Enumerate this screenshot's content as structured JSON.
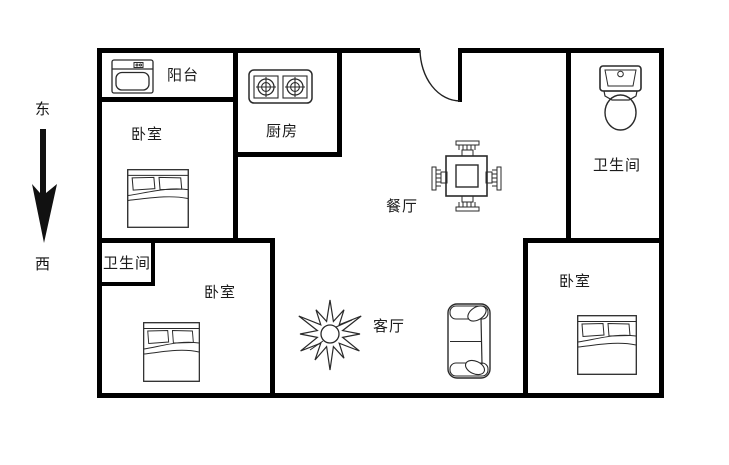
{
  "page": {
    "type": "apartment-floor-plan",
    "background_color": "#ffffff",
    "wall_color": "#000000",
    "furniture_line_color": "#2a2a2a"
  },
  "compass": {
    "east_label": "东",
    "west_label": "西",
    "arrow_direction": "down"
  },
  "rooms": [
    {
      "name": "balcony",
      "label": "阳台"
    },
    {
      "name": "bedroom-northwest",
      "label": "卧室"
    },
    {
      "name": "kitchen",
      "label": "厨房"
    },
    {
      "name": "dining-room",
      "label": "餐厅"
    },
    {
      "name": "bathroom-north",
      "label": "卫生间"
    },
    {
      "name": "bathroom-west",
      "label": "卫生间"
    },
    {
      "name": "bedroom-southwest",
      "label": "卧室"
    },
    {
      "name": "living-room",
      "label": "客厅"
    },
    {
      "name": "bedroom-southeast",
      "label": "卧室"
    }
  ],
  "furniture": [
    {
      "name": "washbasin",
      "room": "balcony"
    },
    {
      "name": "gas-stove-two-burners",
      "room": "kitchen"
    },
    {
      "name": "dining-table-with-chairs",
      "room": "dining-room"
    },
    {
      "name": "toilet",
      "room": "bathroom-north"
    },
    {
      "name": "double-bed",
      "room": "bedroom-northwest"
    },
    {
      "name": "double-bed",
      "room": "bedroom-southwest"
    },
    {
      "name": "double-bed",
      "room": "bedroom-southeast"
    },
    {
      "name": "plant",
      "room": "living-room"
    },
    {
      "name": "sofa",
      "room": "living-room"
    },
    {
      "name": "entry-door-swing",
      "room": "dining-room"
    }
  ]
}
